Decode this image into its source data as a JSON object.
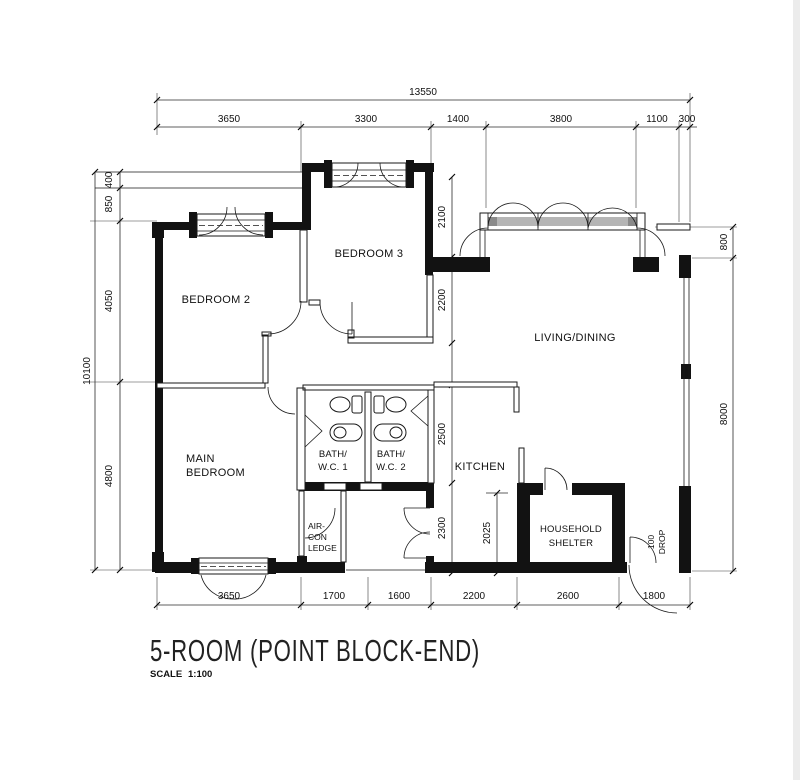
{
  "title": {
    "text": "5-ROOM (POINT BLOCK-END)",
    "scale_label": "SCALE",
    "scale_value": "1:100"
  },
  "rooms": {
    "bedroom2": "BEDROOM 2",
    "bedroom3": "BEDROOM 3",
    "living_dining": "LIVING/DINING",
    "main_bedroom": [
      "MAIN",
      "BEDROOM"
    ],
    "bath_wc1": [
      "BATH/",
      "W.C. 1"
    ],
    "bath_wc2": [
      "BATH/",
      "W.C. 2"
    ],
    "kitchen": "KITCHEN",
    "household_shelter": [
      "HOUSEHOLD",
      "SHELTER"
    ],
    "aircon_ledge": [
      "AIR-",
      "CON",
      "LEDGE"
    ],
    "drop_note": [
      "100",
      "DROP"
    ]
  },
  "dims": {
    "top_total": "13550",
    "top": [
      "3650",
      "3300",
      "1400",
      "3800",
      "1100",
      "300"
    ],
    "left_total": "10100",
    "left": [
      "400",
      "850",
      "4050",
      "4800"
    ],
    "right": [
      "800",
      "8000"
    ],
    "bottom": [
      "3650",
      "1700",
      "1600",
      "2200",
      "2600",
      "1800"
    ],
    "bed3_depth_upper": "2100",
    "bed3_depth_lower": "2200",
    "kitchen_depth_upper": "2500",
    "kitchen_depth_lower": "2300",
    "kitchen_clear": "2025"
  },
  "colors": {
    "line": "#1a1a1a",
    "wall": "#121212",
    "glazing": "#b5b5b5",
    "page_edge": "#ececec",
    "background": "#ffffff"
  }
}
